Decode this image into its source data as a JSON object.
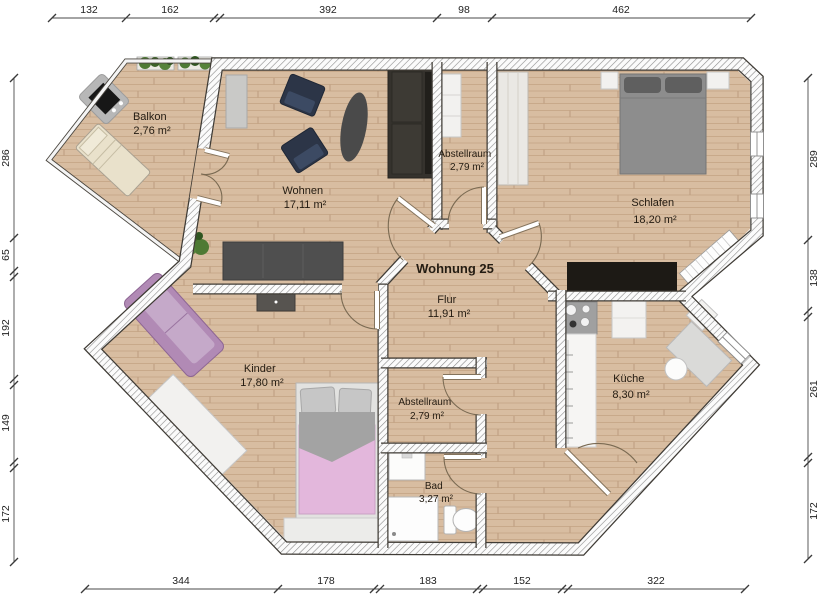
{
  "title": "Wohnung 25",
  "rooms": {
    "balkon": {
      "name": "Balkon",
      "area": "2,76 m²"
    },
    "wohnen": {
      "name": "Wohnen",
      "area": "17,11 m²"
    },
    "abstellraum_oben": {
      "name": "Abstellraum",
      "area": "2,79 m²"
    },
    "schlafen": {
      "name": "Schlafen",
      "area": "18,20 m²"
    },
    "flur": {
      "name": "Flur",
      "area": "11,91 m²"
    },
    "kinder": {
      "name": "Kinder",
      "area": "17,80 m²"
    },
    "abstellraum_unten": {
      "name": "Abstellraum",
      "area": "2,79 m²"
    },
    "kueche": {
      "name": "Küche",
      "area": "8,30 m²"
    },
    "bad": {
      "name": "Bad",
      "area": "3,27 m²"
    }
  },
  "dims": {
    "top": [
      "132",
      "162",
      "392",
      "98",
      "462"
    ],
    "bottom": [
      "344",
      "178",
      "183",
      "152",
      "322"
    ],
    "left": [
      "286",
      "65",
      "192",
      "149",
      "172"
    ],
    "right": [
      "289",
      "138",
      "261",
      "172"
    ]
  },
  "colors": {
    "floor_base": "#d8bda1",
    "floor_grain": "#c8a98a",
    "wall_line": "#3f3b35",
    "sofa_dark": "#35322d",
    "armchair_navy": "#2c3547",
    "kinder_sofa_purple": "#b18ab5",
    "kinder_bed_pink": "#e3b7dc",
    "schlafen_bed_gray": "#8d8d8d",
    "dresser_black": "#1d1a15",
    "plant_green": "#4e7a34",
    "label_text": "#241c12",
    "dimension_text": "#222222"
  }
}
